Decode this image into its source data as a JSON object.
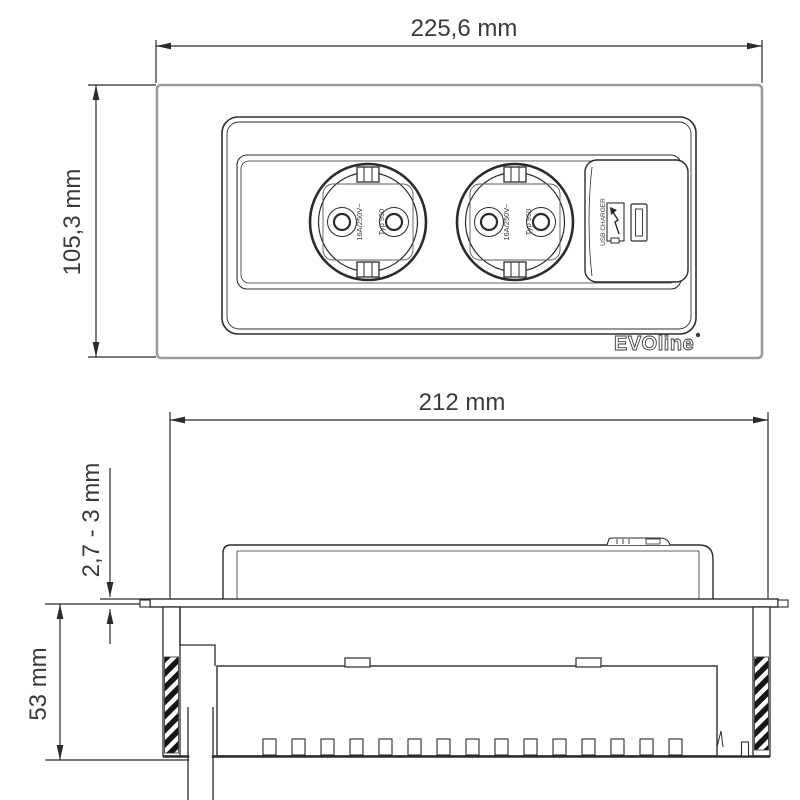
{
  "top_view": {
    "dim_width_label": "225,6 mm",
    "dim_height_label": "105,3 mm",
    "brand_label": "EVOline",
    "sockets": [
      {
        "rating": "16A/250V~",
        "type": "Typ 950"
      },
      {
        "rating": "16A/250V~",
        "type": "Typ 950"
      }
    ],
    "usb": {
      "label": "USB CHARGER"
    }
  },
  "side_view": {
    "dim_width_label": "212 mm",
    "dim_plate_label": "2,7 - 3 mm",
    "dim_depth_label": "53 mm"
  },
  "colors": {
    "line": "#2b2b2b",
    "panel_outline": "#9b9b9b",
    "background": "#ffffff"
  }
}
